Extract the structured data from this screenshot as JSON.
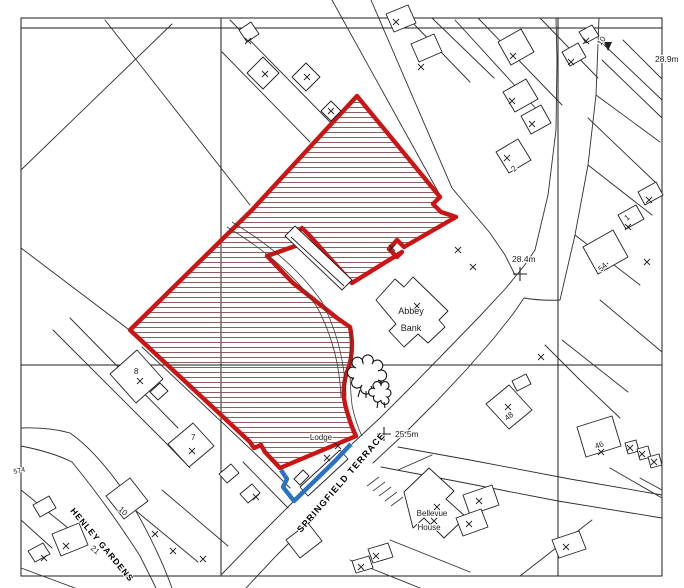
{
  "map": {
    "type": "site-location-plan",
    "colors": {
      "site_boundary_red": "#cc1414",
      "ownership_boundary_blue": "#2a72c4",
      "hatch_brown": "#8c5f5f",
      "linework": "#2e2e2e"
    },
    "street_names": {
      "springfield_terrace": "SPRINGFIELD TERRACE",
      "henley_gardens": "HENLEY GARDENS"
    },
    "building_names": {
      "abbey_line1": "Abbey",
      "abbey_line2": "Bank",
      "lodge": "Lodge",
      "bellevue_line1": "Bellevue",
      "bellevue_line2": "House"
    },
    "spot_levels": {
      "north_east": "28.9m",
      "centre": "28.4m",
      "south_west": "25.5m"
    },
    "plot_numbers": {
      "p10_ne": "10",
      "p2": "2",
      "p1": "1",
      "p54": "54",
      "p48": "48",
      "p46": "46",
      "p8": "8",
      "p7": "7",
      "p574": "574",
      "p10_sw": "10",
      "p21": "21"
    },
    "survey_crosses": [
      [
        248,
        41
      ],
      [
        265,
        74
      ],
      [
        307,
        77
      ],
      [
        331,
        111
      ],
      [
        396,
        22
      ],
      [
        421,
        67
      ],
      [
        513,
        56
      ],
      [
        586,
        41
      ],
      [
        571,
        62
      ],
      [
        512,
        101
      ],
      [
        532,
        124
      ],
      [
        458,
        250
      ],
      [
        473,
        267
      ],
      [
        417,
        306
      ],
      [
        541,
        357
      ],
      [
        392,
        248
      ],
      [
        507,
        158
      ],
      [
        649,
        200
      ],
      [
        628,
        227
      ],
      [
        605,
        266
      ],
      [
        647,
        262
      ],
      [
        508,
        407
      ],
      [
        601,
        452
      ],
      [
        630,
        448
      ],
      [
        642,
        454
      ],
      [
        654,
        462
      ],
      [
        437,
        507
      ],
      [
        434,
        521
      ],
      [
        479,
        501
      ],
      [
        469,
        524
      ],
      [
        566,
        547
      ],
      [
        338,
        446
      ],
      [
        327,
        458
      ],
      [
        256,
        497
      ],
      [
        140,
        381
      ],
      [
        192,
        451
      ],
      [
        155,
        534
      ],
      [
        173,
        551
      ],
      [
        203,
        559
      ],
      [
        44,
        558
      ],
      [
        66,
        546
      ],
      [
        376,
        556
      ],
      [
        361,
        567
      ]
    ]
  }
}
